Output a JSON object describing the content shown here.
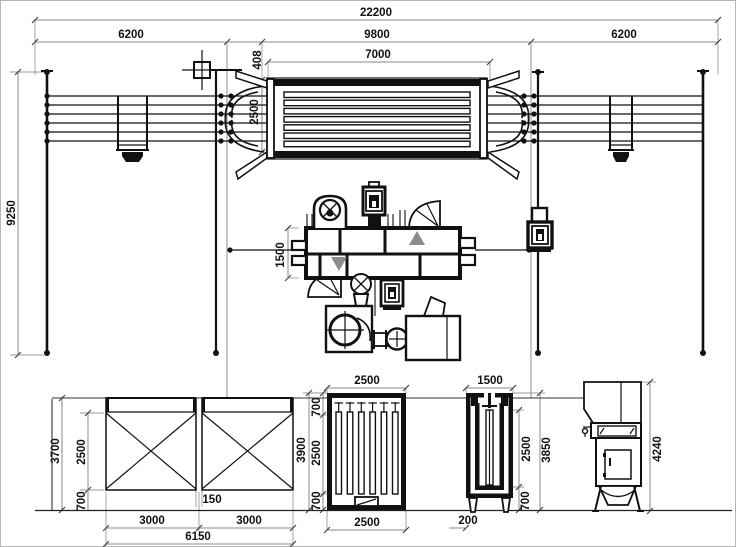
{
  "drawing_title": "wire-galvanizing-line-layout",
  "accent_colors": {
    "line": "#111111",
    "dimension": "#8a8a8a",
    "flow_arrow": "#8c8c8c"
  },
  "dims": {
    "overall_length": "22200",
    "left_bay": "6200",
    "center_bay": "9800",
    "right_bay": "6200",
    "furnace_length": "7000",
    "furnace_offset": "408",
    "furnace_width": "2500",
    "tower_height": "9250",
    "machine_width": "1500",
    "tank_height": "3700",
    "tank_depth": "2500",
    "tank_leg": "700",
    "tank_overall_height": "3900",
    "tank_gap": "150",
    "tank1_width": "3000",
    "tank2_width": "3000",
    "tanks_overall_width": "6150",
    "bath_top_width": "2500",
    "bath_top_clear": "700",
    "bath_depth": "2500",
    "bath_bottom_clear": "700",
    "bath_bottom_width": "2500",
    "vessel_width": "1500",
    "vessel_depth": "2500",
    "vessel_leg": "700",
    "vessel_overall_height": "3850",
    "vessel_offset": "200",
    "filter_height": "4240"
  }
}
